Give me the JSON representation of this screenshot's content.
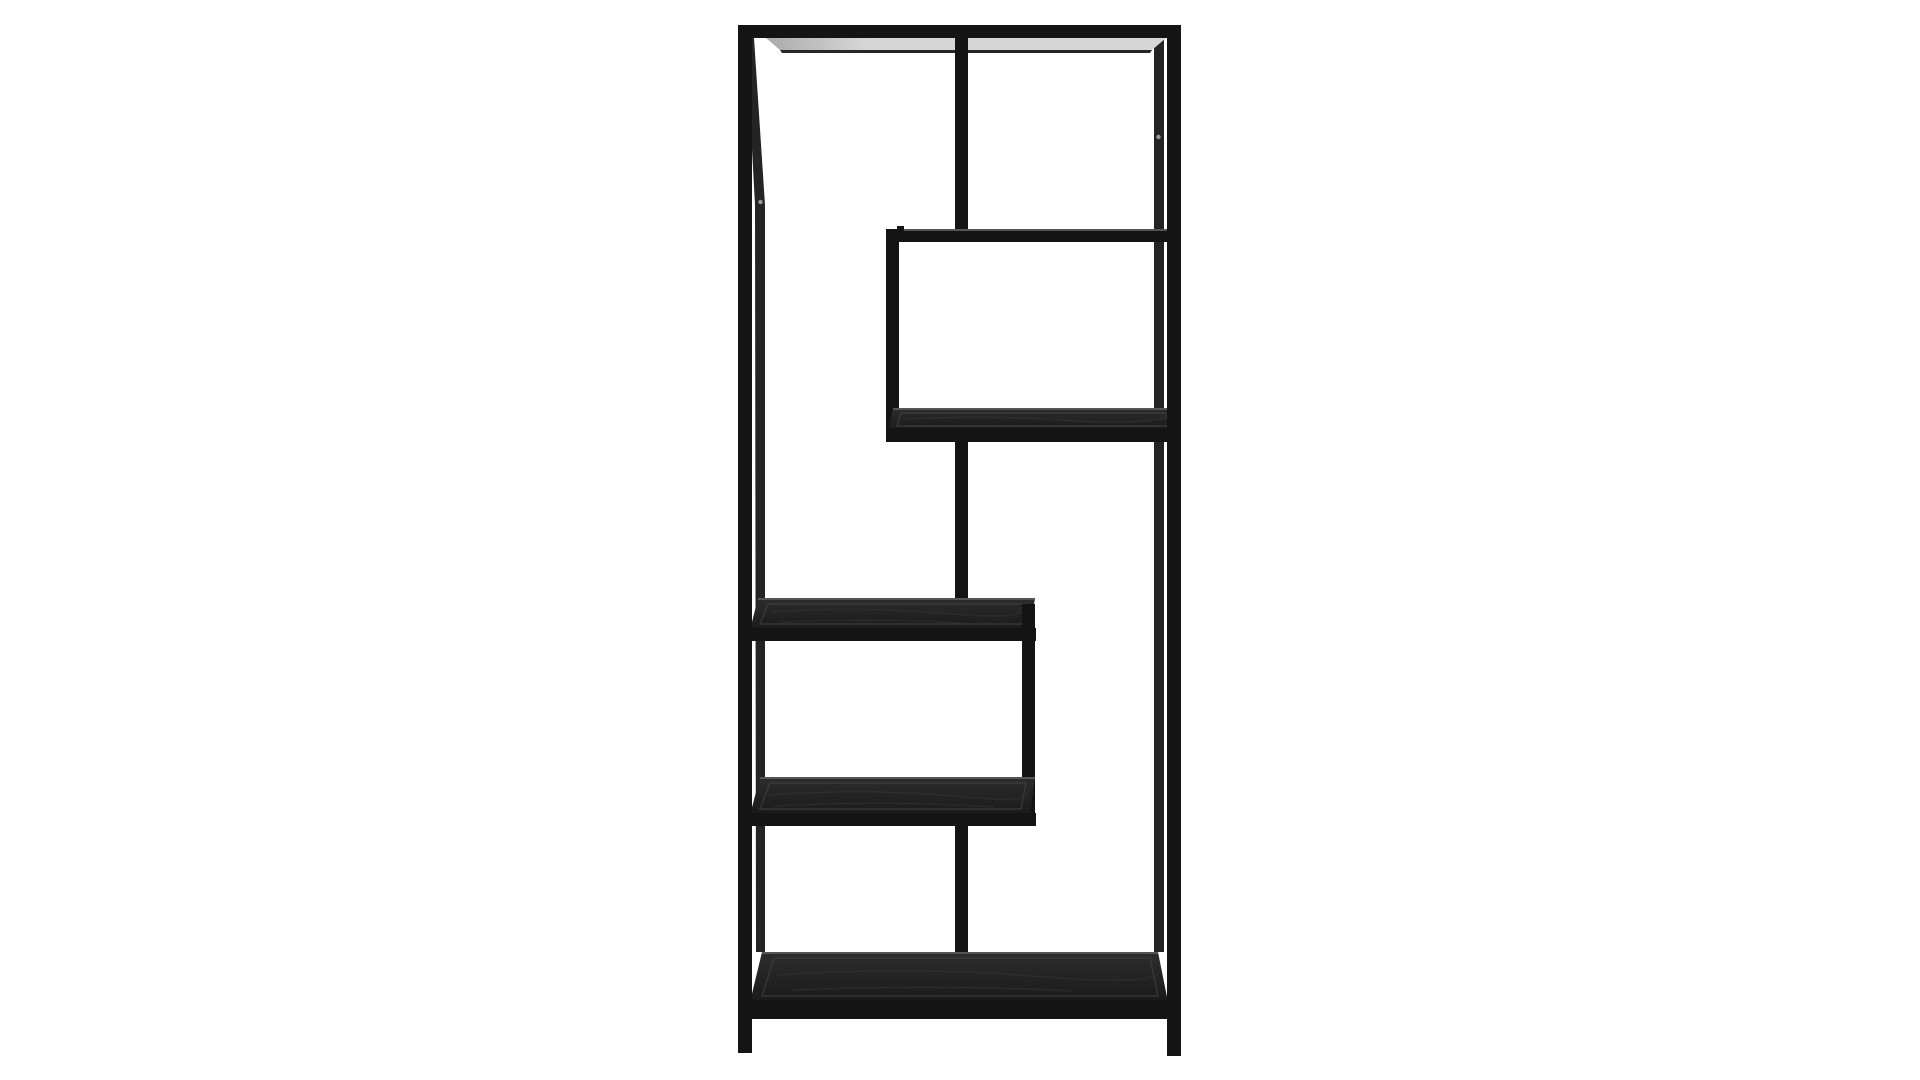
{
  "meta": {
    "type": "product-photo",
    "subject": "Tall asymmetric black metal etagere bookcase with staggered open shelves, front view",
    "background": "seamless white studio background",
    "shelf_levels": 6
  },
  "colors": {
    "background": "#ffffff",
    "frame": "#141414",
    "frame_back": "#242424",
    "wood_light": "#2d2d2d",
    "wood_dark": "#1a1a1a",
    "edge_highlight": "#555555",
    "inset_line": "#404040",
    "grain": "#343434",
    "underside_light": "#d6d6d6",
    "underside_dark": "#aaaaaa",
    "back_beam": "#262626",
    "screw": "#9a9a9a"
  }
}
